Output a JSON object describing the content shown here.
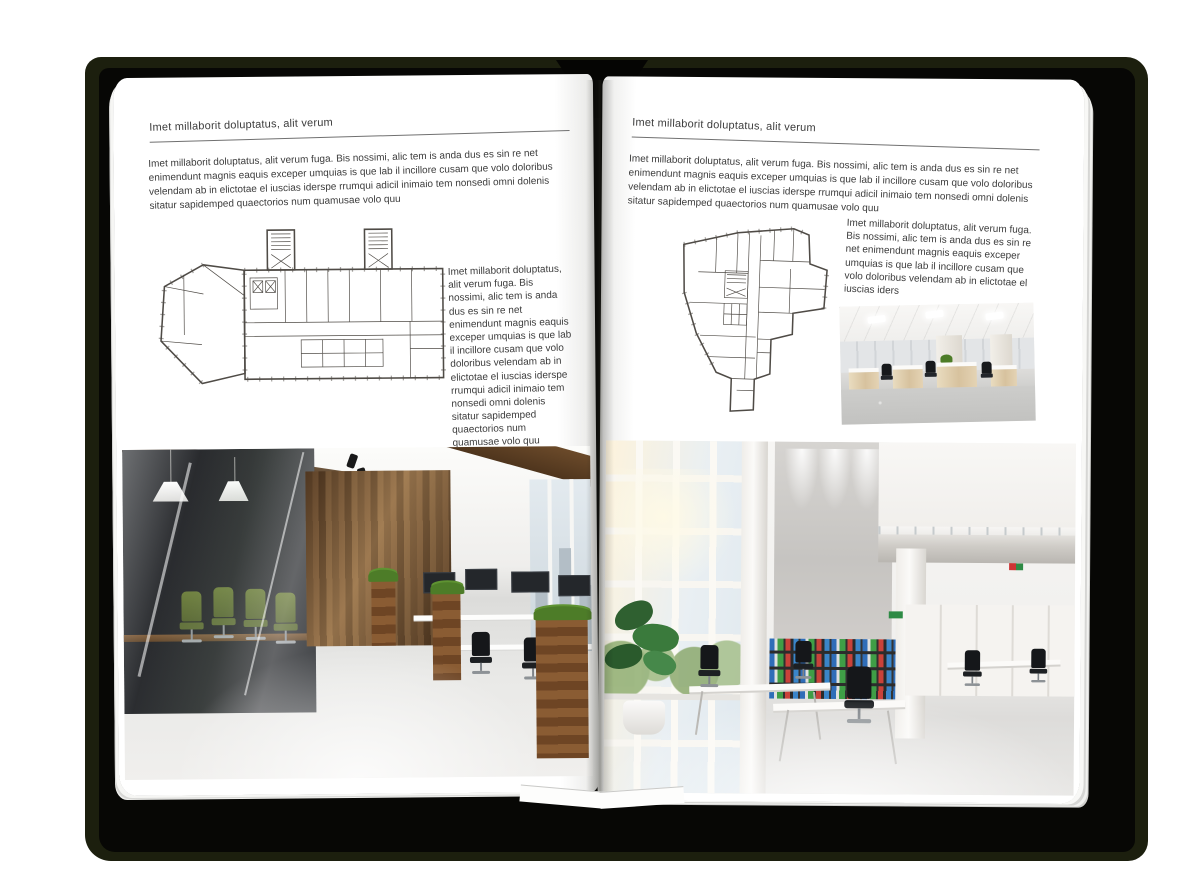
{
  "colors": {
    "cover": "#1c1f0e",
    "cover_inner": "#070705",
    "page": "#ffffff",
    "text": "#3c3c3c",
    "rule": "#707070",
    "plan_line": "#4f4b46",
    "wood_dark": "#5d4226",
    "chair_green": "#5c6e2f",
    "plant_green": "#4d7c28",
    "binder_blue": "#2f6db8",
    "binder_green": "#3f9e46",
    "binder_red": "#c9423a"
  },
  "left_page": {
    "header": "Imet millaborit doluptatus, alit verum",
    "intro": "Imet millaborit doluptatus, alit verum fuga. Bis nossimi, alic tem is anda dus es sin re net enimendunt magnis eaquis exceper umquias is que lab il incillore cusam que volo doloribus velendam ab in elictotae el iuscias iderspe rrumqui adicil inimaio tem nonsedi omni dolenis sitatur sapidemped quaectorios num quamusae volo quu",
    "side_text": "Imet millaborit doluptatus, alit verum fuga. Bis nossimi, alic tem is anda dus es sin re net enimendunt magnis eaquis exceper umquias is que lab il incillore cusam que volo doloribus velendam ab in elictotae el iuscias iderspe rrumqui adicil inimaio tem nonsedi omni dolenis sitatur sapidemped quaectorios num quamusae volo quu"
  },
  "right_page": {
    "header": "Imet millaborit doluptatus, alit verum",
    "intro": "Imet millaborit doluptatus, alit verum fuga. Bis nossimi, alic tem is anda dus es sin re net enimendunt magnis eaquis exceper umquias is que lab il incillore cusam que volo doloribus velendam ab in elictotae el iuscias iderspe rrumqui adicil inimaio tem nonsedi omni dolenis sitatur sapidemped quaectorios num quamusae volo quu",
    "side_text": "Imet millaborit doluptatus, alit verum fuga. Bis nossimi, alic tem is anda dus es sin re net enimendunt magnis eaquis exceper umquias is que lab il incillore cusam que volo doloribus velendam ab in elictotae el iuscias iders"
  }
}
